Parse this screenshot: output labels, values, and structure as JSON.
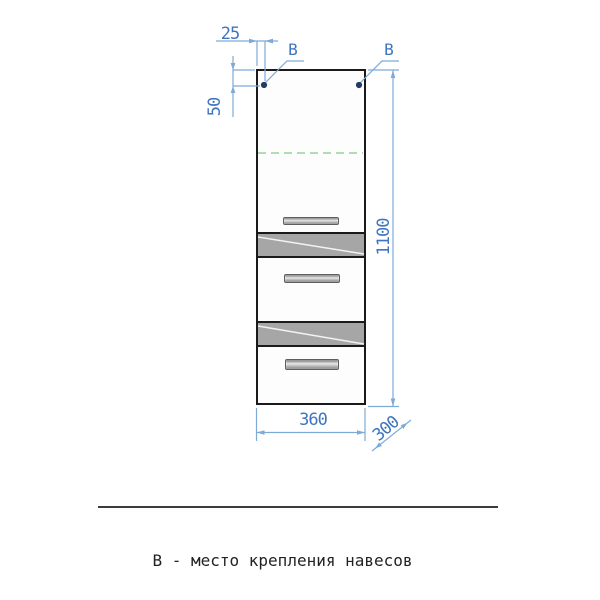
{
  "drawing": {
    "caption": "В - место крепления навесов",
    "dimensions": {
      "hole_offset_x": "25",
      "hole_offset_y": "50",
      "height": "1100",
      "width": "360",
      "depth": "300"
    },
    "mount_labels": {
      "left": "В",
      "right": "В"
    },
    "colors": {
      "dimension_text": "#3f74c1",
      "dimension_line": "#7fa9d6",
      "mount_dot": "#223a66",
      "shelf_dashed_line": "#96d496",
      "outline": "#1a1a1a",
      "drawer_top_gray": "#a6a6a6"
    }
  }
}
